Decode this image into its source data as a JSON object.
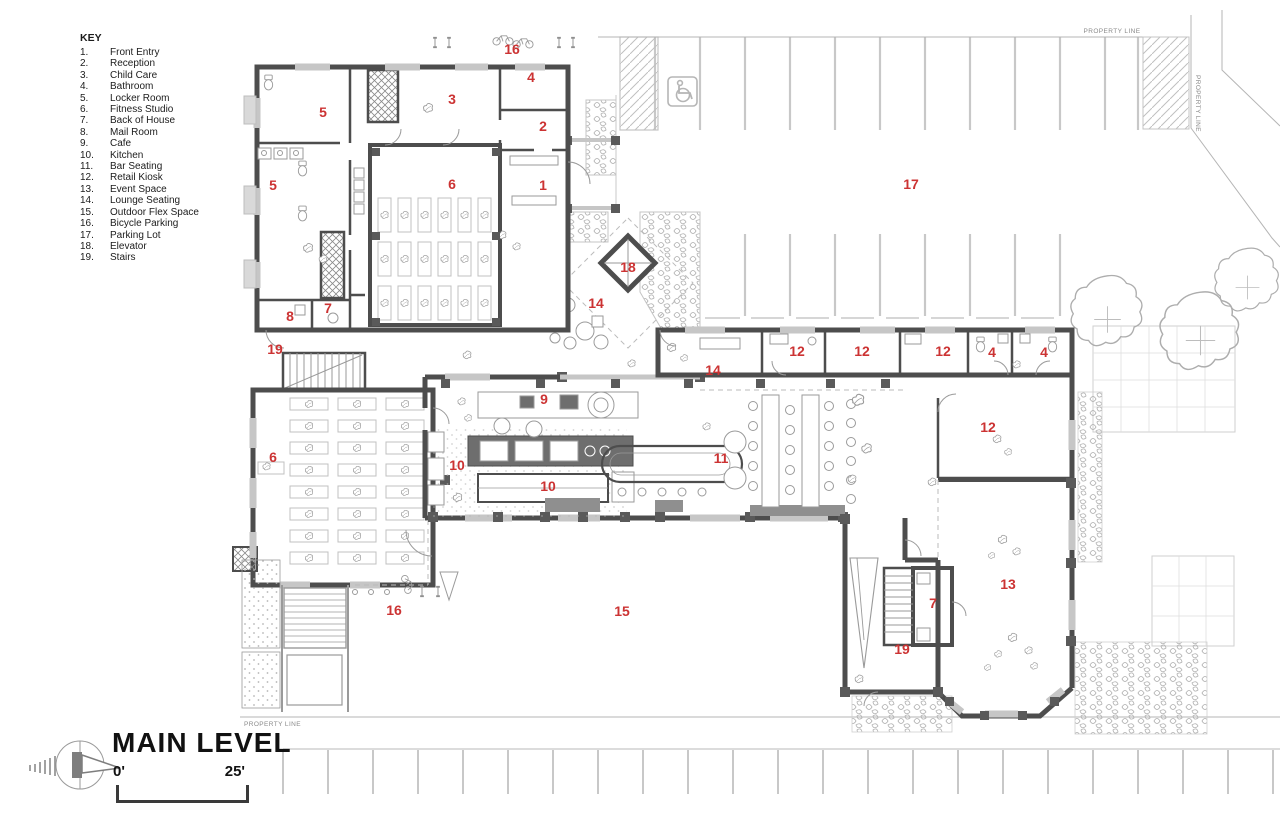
{
  "sheet": {
    "title": "MAIN LEVEL",
    "scale": {
      "start": "0'",
      "end": "25'"
    },
    "property_line_text": "PROPERTY LINE"
  },
  "key": {
    "heading": "KEY",
    "items": [
      {
        "num": "1.",
        "label": "Front Entry"
      },
      {
        "num": "2.",
        "label": "Reception"
      },
      {
        "num": "3.",
        "label": "Child Care"
      },
      {
        "num": "4.",
        "label": "Bathroom"
      },
      {
        "num": "5.",
        "label": "Locker Room"
      },
      {
        "num": "6.",
        "label": "Fitness Studio"
      },
      {
        "num": "7.",
        "label": "Back of House"
      },
      {
        "num": "8.",
        "label": "Mail Room"
      },
      {
        "num": "9.",
        "label": "Cafe"
      },
      {
        "num": "10.",
        "label": "Kitchen"
      },
      {
        "num": "11.",
        "label": "Bar Seating"
      },
      {
        "num": "12.",
        "label": "Retail Kiosk"
      },
      {
        "num": "13.",
        "label": "Event Space"
      },
      {
        "num": "14.",
        "label": "Lounge Seating"
      },
      {
        "num": "15.",
        "label": "Outdoor Flex Space"
      },
      {
        "num": "16.",
        "label": "Bicycle Parking"
      },
      {
        "num": "17.",
        "label": "Parking Lot"
      },
      {
        "num": "18.",
        "label": "Elevator"
      },
      {
        "num": "19.",
        "label": "Stairs"
      }
    ]
  },
  "plan": {
    "labels": [
      {
        "n": "1",
        "x": 543,
        "y": 190
      },
      {
        "n": "2",
        "x": 543,
        "y": 131
      },
      {
        "n": "3",
        "x": 452,
        "y": 104
      },
      {
        "n": "4",
        "x": 531,
        "y": 82
      },
      {
        "n": "4",
        "x": 992,
        "y": 357
      },
      {
        "n": "4",
        "x": 1044,
        "y": 357
      },
      {
        "n": "5",
        "x": 323,
        "y": 117
      },
      {
        "n": "5",
        "x": 273,
        "y": 190
      },
      {
        "n": "6",
        "x": 452,
        "y": 189
      },
      {
        "n": "6",
        "x": 273,
        "y": 462
      },
      {
        "n": "7",
        "x": 328,
        "y": 313
      },
      {
        "n": "7",
        "x": 933,
        "y": 608
      },
      {
        "n": "8",
        "x": 290,
        "y": 321
      },
      {
        "n": "9",
        "x": 544,
        "y": 404
      },
      {
        "n": "10",
        "x": 457,
        "y": 470
      },
      {
        "n": "10",
        "x": 548,
        "y": 491
      },
      {
        "n": "11",
        "x": 721,
        "y": 463
      },
      {
        "n": "12",
        "x": 797,
        "y": 356
      },
      {
        "n": "12",
        "x": 862,
        "y": 356
      },
      {
        "n": "12",
        "x": 943,
        "y": 356
      },
      {
        "n": "12",
        "x": 988,
        "y": 432
      },
      {
        "n": "13",
        "x": 1008,
        "y": 589
      },
      {
        "n": "14",
        "x": 596,
        "y": 308
      },
      {
        "n": "14",
        "x": 713,
        "y": 375
      },
      {
        "n": "15",
        "x": 622,
        "y": 616
      },
      {
        "n": "16",
        "x": 512,
        "y": 54
      },
      {
        "n": "16",
        "x": 394,
        "y": 615
      },
      {
        "n": "17",
        "x": 911,
        "y": 189
      },
      {
        "n": "18",
        "x": 628,
        "y": 272
      },
      {
        "n": "19",
        "x": 275,
        "y": 354
      },
      {
        "n": "19",
        "x": 902,
        "y": 654
      }
    ],
    "property_lines": [
      {
        "x": 1112,
        "y": 33,
        "rotate": 0,
        "anchor": "middle"
      },
      {
        "x": 1196,
        "y": 75,
        "rotate": 90,
        "anchor": "start"
      },
      {
        "x": 244,
        "y": 726,
        "rotate": 0,
        "anchor": "start"
      }
    ]
  },
  "colors": {
    "label_red": "#cc3333",
    "wall_dark": "#4d4d4d",
    "window_gray": "#c6c6c6",
    "fixture_gray": "#9a9a9a",
    "site_gray": "#c4c4c4"
  }
}
